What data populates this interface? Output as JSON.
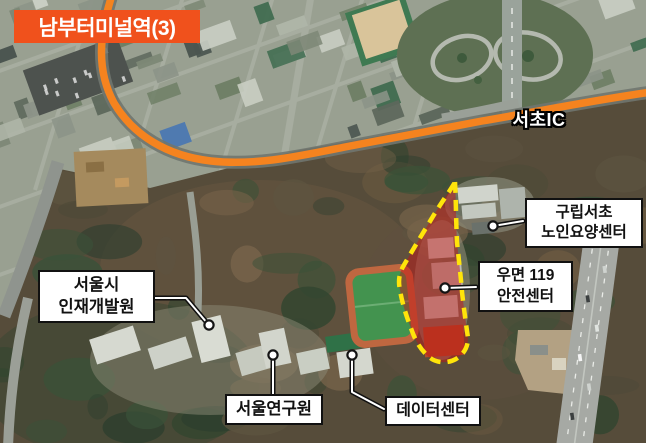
{
  "map": {
    "station_badge": {
      "label": "남부터미널역(3)"
    },
    "road_label": "서초IC",
    "callouts": [
      {
        "id": "injae",
        "lines": [
          "서울시",
          "인재개발원"
        ]
      },
      {
        "id": "gurip",
        "lines": [
          "구립서초",
          "노인요양센터"
        ]
      },
      {
        "id": "umyeon",
        "lines": [
          "우면 119",
          "안전센터"
        ]
      },
      {
        "id": "research",
        "lines": [
          "서울연구원"
        ]
      },
      {
        "id": "datacenter",
        "lines": [
          "데이터센터"
        ]
      }
    ],
    "colors": {
      "route_orange": "#f5831f",
      "badge_orange": "#f0511c",
      "highlight_fill": "rgba(197,20,20,0.48)",
      "highlight_border": "#ffe40a",
      "callout_bg": "#ffffff",
      "callout_border": "#111111",
      "callout_text": "#111111",
      "road_label_text": "#ffffff"
    }
  }
}
